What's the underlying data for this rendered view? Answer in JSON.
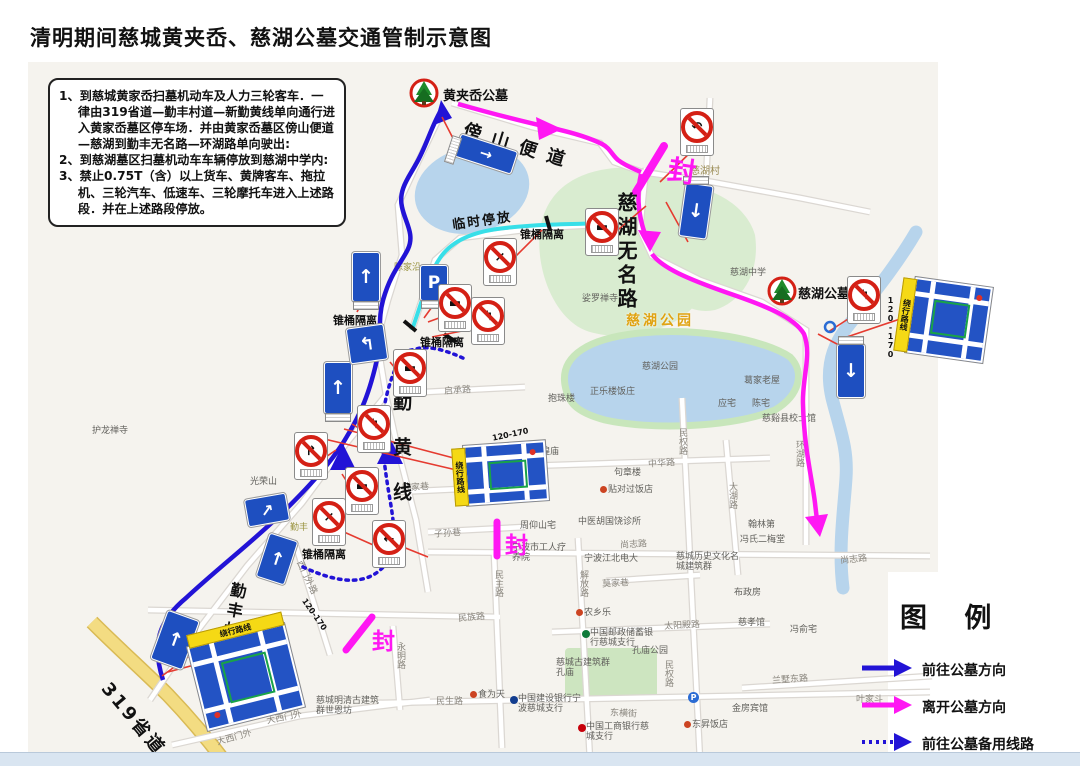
{
  "title": "清明期间慈城黄夹岙、慈湖公墓交通管制示意图",
  "notice": {
    "items": [
      "1、到慈城黄家岙扫墓机动车及人力三轮客车．一律由319省道—勤丰村道—新勤黄线单向通行进入黄家岙墓区停车场．并由黄家岙墓区傍山便道—慈湖到勤丰无名路—环湖路单向驶出:",
      "2、到慈湖墓区扫墓机动车车辆停放到慈湖中学内:",
      "3、禁止0.75T（含）以上货车、黄牌客车、拖拉机、三轮汽车、低速车、三轮摩托车进入上述路段．并在上述路段停放。"
    ]
  },
  "legend": {
    "title": "图 例",
    "items": [
      {
        "label": "前往公墓方向",
        "style": "blue-solid"
      },
      {
        "label": "离开公墓方向",
        "style": "magenta-solid"
      },
      {
        "label": "前往公墓备用线路",
        "style": "blue-dotted"
      }
    ]
  },
  "map": {
    "cemeteries": {
      "huangjiaao": "黄夹岙公墓",
      "cihu": "慈湖公墓"
    },
    "big_roads": {
      "pangshan": "傍山便道",
      "wuming": "慈湖无名路",
      "qinhuang": "勤黄线",
      "qinfeng": "勤丰村道",
      "s319": "319省道"
    },
    "labels": {
      "cihu_park": "慈湖公园",
      "cihu_village": "慈湖村",
      "temp_parking": "临时停放",
      "cone": "锥桶隔离",
      "closed": "封"
    },
    "sign_text": {
      "detour": "绕行路线",
      "detour_code": "120-170",
      "parking": "P"
    },
    "roads": [
      "西门外路",
      "永明路",
      "民生路",
      "大西门外",
      "大西门外",
      "民族路",
      "民主路",
      "解放路",
      "子孙巷",
      "顾家巷",
      "启承路",
      "尚志路",
      "尚志路",
      "中华路",
      "民权路",
      "民权路",
      "大湖路",
      "莫家巷",
      "太阳殿路",
      "东横街",
      "兰墅东路",
      "环湖路",
      "陈家沿",
      "叶家斗",
      "勤丰"
    ],
    "pois": [
      "娑罗禅寺",
      "护龙禅寺",
      "光荣山",
      "慈湖中学",
      "慈湖公园",
      "正乐楼饭庄",
      "抱珠楼",
      "葛家老屋",
      "应宅",
      "陈宅",
      "慈谿县校士馆",
      "城隍庙",
      "句章楼",
      "贴对过饭店",
      "周仰山宅",
      "中医胡国饶诊所",
      "宁波市工人疗养院",
      "宁波江北电大",
      "翰林第",
      "冯氏二梅堂",
      "布政房",
      "慈城历史文化名城建筑群",
      "慈孝馆",
      "冯俞宅",
      "农乡乐",
      "孔庙公园",
      "慈城古建筑群孔庙",
      "中国邮政储蓄银行慈城支行",
      "食为天",
      "中国建设银行宁波慈城支行",
      "中国工商银行慈城支行",
      "金房宾馆",
      "东昇饭店",
      "慈城明清古建筑群世恩坊"
    ]
  },
  "colors": {
    "route_to_cemetery": "#2213d6",
    "route_leave_cemetery": "#ff17f3",
    "route_backup": "#2213d6",
    "temporary_parking_line": "#38dfe8",
    "closure_mark": "#ff17f3",
    "sign_blue": "#1e4fc0",
    "ban_red": "#d42015",
    "water": "#b7d4ec",
    "park_green": "#d9ecd0",
    "provincial_road_yellow": "#f3dc82"
  }
}
